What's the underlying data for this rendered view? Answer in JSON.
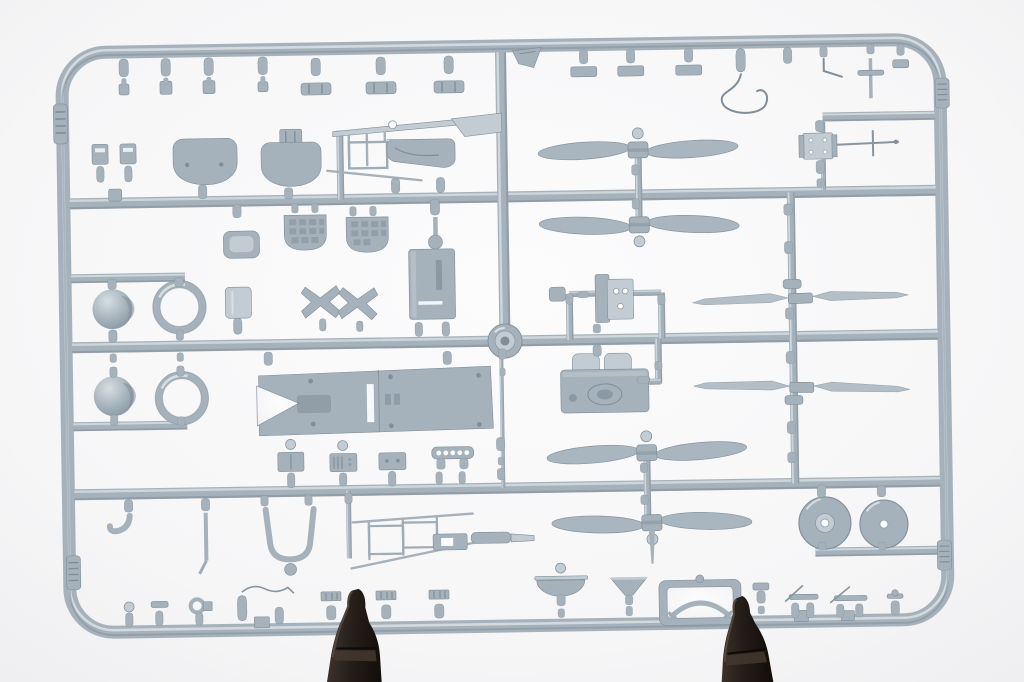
{
  "image": {
    "kind": "photograph",
    "description": "Injection-moulded model kit sprue of blue-grey plastic aircraft parts on a white backdrop, clamped at the bottom by two dark plastic clips",
    "orientation": "landscape"
  },
  "colors": {
    "background": "#f5f5f6",
    "background_center": "#fcfcfd",
    "plastic": "#a6b2bb",
    "plastic_light": "#c2ccd2",
    "plastic_highlight": "#dae1e5",
    "plastic_shadow": "#7f8e99",
    "plastic_deep": "#6e7d88",
    "clip": "#241c17",
    "clip_highlight": "#53453c"
  },
  "sprue": {
    "frame_shape": "rounded-rectangle",
    "horizontal_runners": 3,
    "vertical_center_runner": 1,
    "injection_boss_position": "center",
    "ribbed_label_tabs": 4
  },
  "parts_inventory": {
    "round_blade_propellers": 4,
    "pointed_blade_propellers": 2,
    "spinner_domes": 2,
    "cowl_rings": 2,
    "wheels": 2,
    "engine_block": 1,
    "bulkhead_panels": 2,
    "waffle_radiator_blocks": 2,
    "instrument_boxes": 4,
    "flat_structural_frames": 3,
    "seat_strap_frame": 1,
    "windscreen_arch_frame": 1,
    "bracket_with_holes": 2,
    "small_fittings_top_row": 16,
    "small_fittings_bottom_row": 14
  },
  "clips": {
    "count": 2,
    "color_name": "dark brown",
    "position": "bottom edge"
  }
}
